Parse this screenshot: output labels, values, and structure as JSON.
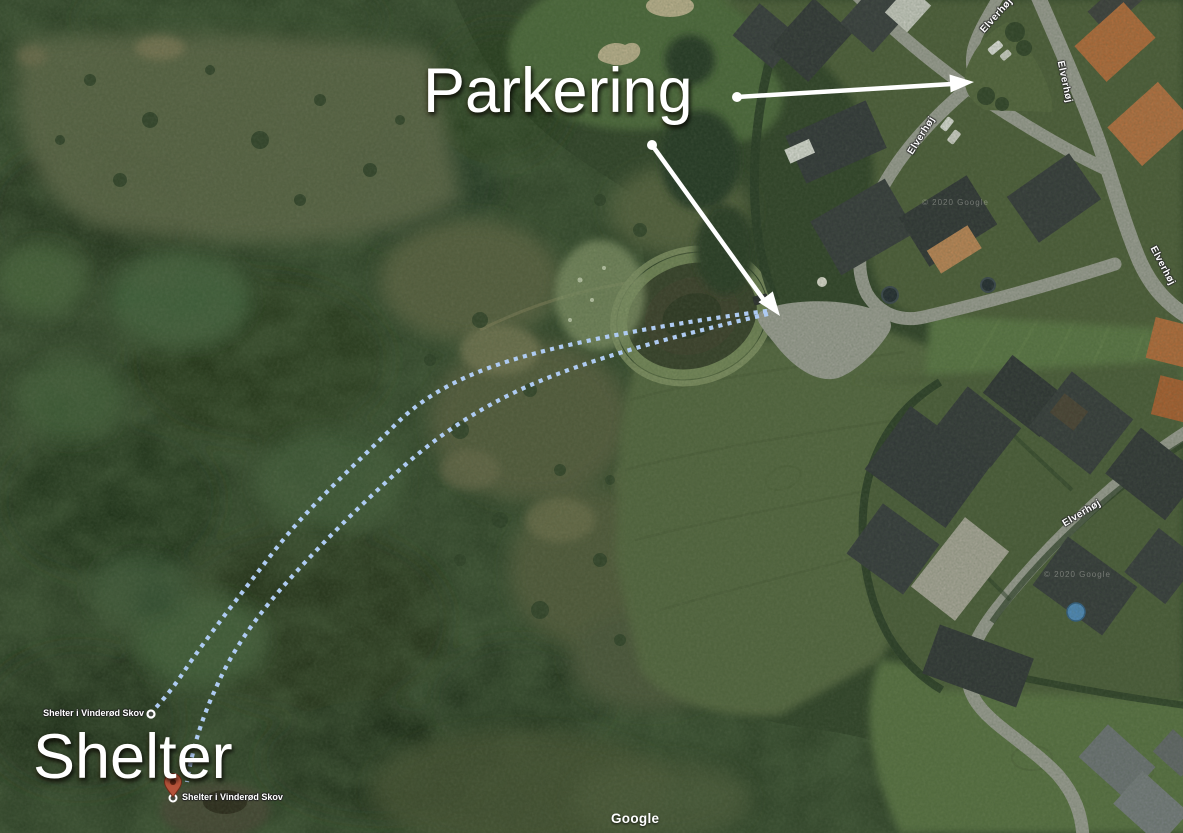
{
  "annotations": {
    "parking_label": "Parkering",
    "shelter_label": "Shelter"
  },
  "map": {
    "street_name": "Elverhøj",
    "poi_top_label": "Shelter i Vinderød Skov",
    "poi_bottom_label": "Shelter i Vinderød Skov",
    "attribution": "Google",
    "copyright": "© 2020 Google"
  },
  "colors": {
    "annotation_text": "#ffffff",
    "arrow": "#ffffff",
    "route_dots": "#aecbf2",
    "pin_fill": "#b5533a",
    "road": "#a3a39b",
    "forest": "#2e4026"
  }
}
